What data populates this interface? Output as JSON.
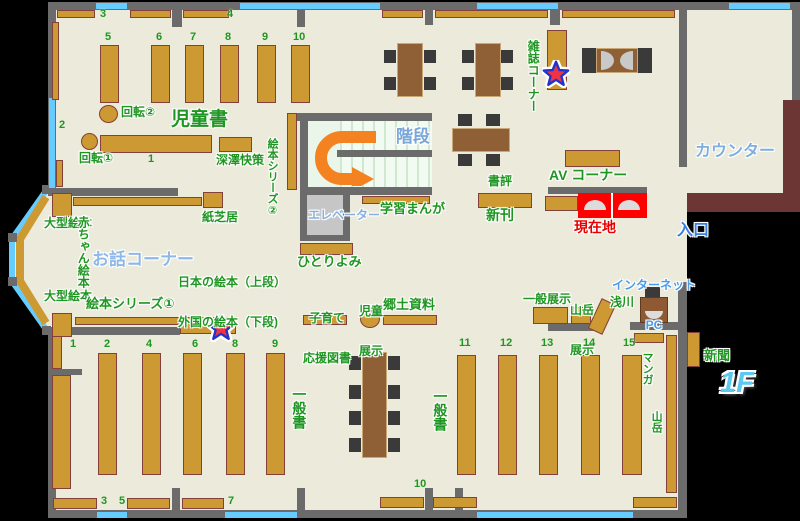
{
  "floor_label": "1F",
  "labels": {
    "jidosho": "児童書",
    "kaiten1": "回転①",
    "kaiten2": "回転②",
    "fukazawa": "深澤快策",
    "ehon_series2": "絵本シリーズ②",
    "kamishibai": "紙芝居",
    "ogata_ehon_upper": "大型絵本",
    "ogata_ehon_lower": "大型絵本",
    "akachan_ehon": "赤ちゃん絵本",
    "ohanashi_corner": "お話コーナー",
    "nihon_no_ehon": "日本の絵本（上段）",
    "gaikoku_no_ehon": "外国の絵本（下段)",
    "ehon_series1": "絵本シリーズ①",
    "kaidan": "階段",
    "elevator": "エレベーター",
    "hitoriyomi": "ひとりよみ",
    "gakushu_manga": "学習まんが",
    "zasshi_corner": "雑誌コーナー",
    "counter": "カウンター",
    "av_corner": "AV コーナー",
    "shohyo": "書評",
    "shinkan": "新刊",
    "genzaichi": "現在地",
    "iriguchi": "入口",
    "internet_line1": "インターネット",
    "internet_line2": "PC",
    "kosodate_line1": "子育て",
    "kosodate_line2": "応援図書",
    "jido_tenji_line1": "児童",
    "jido_tenji_line2": "展示",
    "kyodo_shiryo": "郷土資料",
    "ippan_tenji": "一般展示",
    "sangaku_tenji_line1": "山岳",
    "sangaku_tenji_line2": "展示",
    "asakawa": "浅川",
    "ippansho_left": "一般書",
    "ippansho_right": "一般書",
    "manga": "マンガ",
    "sangaku": "山岳",
    "shinbun": "新聞"
  },
  "shelf_numbers": {
    "children_wall_3": "3",
    "children_wall_4": "4",
    "children_upper": [
      "5",
      "6",
      "7",
      "8",
      "9",
      "10"
    ],
    "children_side": "2",
    "children_center": "1",
    "general_top_row": [
      "1",
      "2",
      "4",
      "6",
      "8",
      "9"
    ],
    "general_bottom_row": [
      "11",
      "12",
      "13",
      "14",
      "15"
    ],
    "general_wall": [
      "3",
      "5",
      "7",
      "10"
    ]
  },
  "colors": {
    "floor": "#ECEBDB",
    "wall": "#6B6B6B",
    "window": "#66CCFF",
    "shelf": "#CC9933",
    "shelf_border": "#84403A",
    "table": "#8F5F35",
    "chair": "#3A3A3A",
    "counter": "#6B3633",
    "highlight_red": "#FF0000",
    "green_text": "#1F9622",
    "blue_text": "#7FAEDF",
    "orange_arrow": "#F58220"
  }
}
